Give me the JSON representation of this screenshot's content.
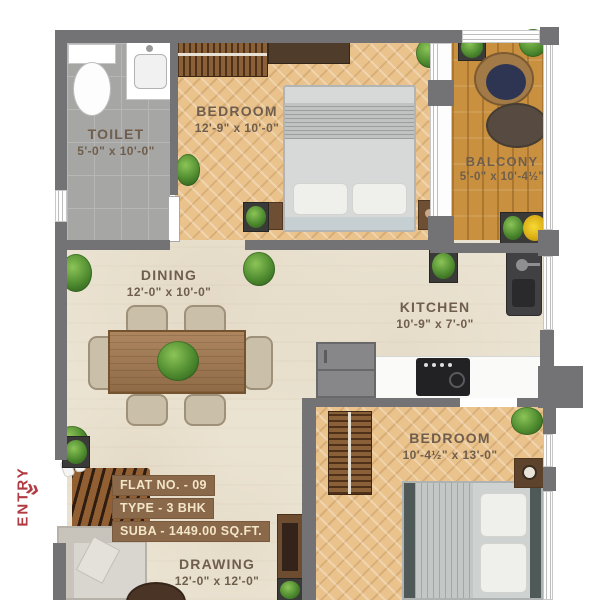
{
  "plan": {
    "entry": {
      "label": "ENTRY",
      "chevrons": "»"
    },
    "rooms": {
      "toilet": {
        "name": "TOILET",
        "dims": "5'-0\" x 10'-0\""
      },
      "bedroom1": {
        "name": "BEDROOM",
        "dims": "12'-9\" x 10'-0\""
      },
      "balcony": {
        "name": "BALCONY",
        "dims": "5'-0\" x 10'-4½\""
      },
      "dining": {
        "name": "DINING",
        "dims": "12'-0\" x 10'-0\""
      },
      "kitchen": {
        "name": "KITCHEN",
        "dims": "10'-9\" x 7'-0\""
      },
      "bedroom2": {
        "name": "BEDROOM",
        "dims": "10'-4½\" x 13'-0\""
      },
      "drawing": {
        "name": "DRAWING",
        "dims": "12'-0\" x 12'-0\""
      }
    },
    "info": {
      "flat": "FLAT NO. - 09",
      "type": "TYPE - 3 BHK",
      "area": "SUBA - 1449.00 SQ.FT."
    },
    "colors": {
      "wall": "#737376",
      "wood_floor": "#eac28c",
      "balcony_floor": "#c9913f",
      "marble_floor": "#ebe3d2",
      "tile_floor": "#a6a6a4",
      "label_text": "#6f5e4c",
      "entry_red": "#b23a42",
      "info_bg": "#8a684a",
      "info_text": "#f3e6c8"
    }
  }
}
